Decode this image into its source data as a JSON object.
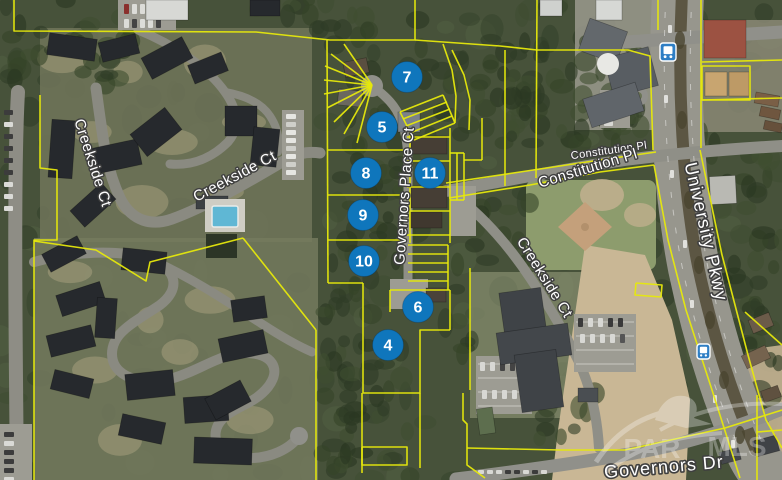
{
  "map": {
    "description": "Aerial parcel map with numbered MLS listing markers",
    "colors": {
      "marker_blue": "#0f76bc",
      "parcel_line_yellow": "#e6e80c",
      "label_halo": "#3f3f3f",
      "label_text": "#ffffff"
    },
    "markers": [
      {
        "label": "4",
        "x": 388,
        "y": 345
      },
      {
        "label": "5",
        "x": 382,
        "y": 127
      },
      {
        "label": "6",
        "x": 418,
        "y": 307
      },
      {
        "label": "7",
        "x": 407,
        "y": 77
      },
      {
        "label": "8",
        "x": 366,
        "y": 173
      },
      {
        "label": "9",
        "x": 363,
        "y": 215
      },
      {
        "label": "10",
        "x": 364,
        "y": 261
      },
      {
        "label": "11",
        "x": 430,
        "y": 173
      }
    ],
    "street_labels": [
      {
        "id": "creekside-ct-west",
        "text": "Creekside Ct",
        "x": 92,
        "y": 163,
        "rot": 72,
        "size": 15
      },
      {
        "id": "creekside-ct-mid",
        "text": "Creekside Ct",
        "x": 235,
        "y": 177,
        "rot": -28,
        "size": 15
      },
      {
        "id": "creekside-ct-south",
        "text": "Creekside Ct",
        "x": 544,
        "y": 278,
        "rot": 58,
        "size": 15
      },
      {
        "id": "governors-place-ct",
        "text": "Governors Place Ct",
        "x": 405,
        "y": 196,
        "rot": -86,
        "size": 15
      },
      {
        "id": "constitution-pl-upper",
        "text": "Constitution Pl",
        "x": 609,
        "y": 151,
        "rot": -8,
        "size": 11
      },
      {
        "id": "constitution-pl-lower",
        "text": "Constitution Pl",
        "x": 588,
        "y": 169,
        "rot": -17,
        "size": 15
      },
      {
        "id": "university-pkwy",
        "text": "University Pkwy",
        "x": 705,
        "y": 232,
        "rot": 77,
        "size": 18
      },
      {
        "id": "governors-dr",
        "text": "Governors Dr",
        "x": 664,
        "y": 468,
        "rot": -5,
        "size": 18
      }
    ],
    "transit_stops": [
      {
        "name": "bus-stop",
        "x": 660,
        "y": 43,
        "w": 16,
        "h": 18
      },
      {
        "name": "bus-stop",
        "x": 697,
        "y": 344,
        "w": 13,
        "h": 15
      }
    ],
    "watermark": {
      "left": "PAR",
      "right": "MLS"
    }
  }
}
